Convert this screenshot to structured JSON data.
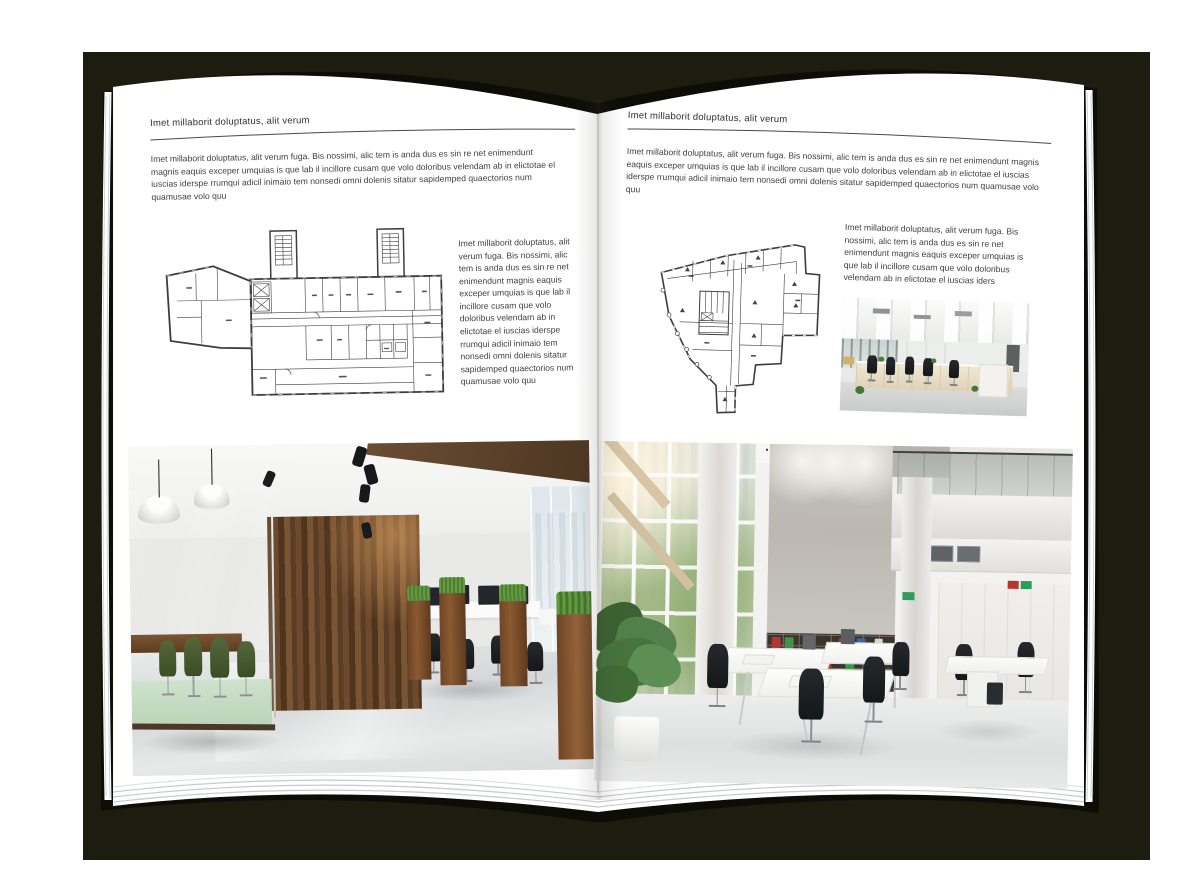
{
  "backdrop": {
    "color": "#1c1d0f"
  },
  "book": {
    "cover_color": "#0d0d07",
    "page_color": "#ffffff",
    "sheet_edge_color": "#c7cacc"
  },
  "left_page": {
    "header": "Imet millaborit doluptatus, alit verum",
    "intro": "Imet millaborit doluptatus, alit verum fuga. Bis nossimi, alic tem is anda dus es sin re net enimendunt magnis eaquis exceper umquias is que lab il incillore cusam que volo doloribus velendam ab in elictotae el iuscias iderspe rrumqui adicil inimaio tem nonsedi omni dolenis sitatur sapidemped quaectorios num quamusae volo quu",
    "side_text": "Imet millaborit doluptatus, alit verum fuga. Bis nossimi, alic tem is anda dus es sin re net enimendunt magnis eaquis exceper umquias is que lab il incillore cusam que volo doloribus velendam ab in elictotae el iuscias iderspe rrumqui adicil inimaio tem nonsedi omni dolenis sitatur sapidemped quaectorios num quamusae volo quu",
    "floorplan": "wide-office-building-floor-plan",
    "photo": "open-office-with-dark-glass-meeting-room-and-wood-wall"
  },
  "right_page": {
    "header": "Imet millaborit doluptatus, alit verum",
    "intro": "Imet millaborit doluptatus, alit verum fuga. Bis nossimi, alic tem is anda dus es sin re net enimendunt magnis eaquis exceper umquias is que lab il incillore cusam que volo doloribus velendam ab in elictotae el iuscias iderspe rrumqui adicil inimaio tem nonsedi omni dolenis sitatur sapidemped quaectorios num quamusae volo quu",
    "side_text": "Imet millaborit doluptatus, alit verum fuga. Bis nossimi, alic tem is anda dus es sin re net enimendunt magnis eaquis exceper umquias is que lab il incillore cusam que volo doloribus velendam ab in elictotae el iuscias iders",
    "floorplan": "irregular-corner-building-floor-plan",
    "photo_small": "white-open-office-desk-rows",
    "photo_large": "double-height-white-office-atrium",
    "binder_colors": [
      "#b23730",
      "#2e66a8",
      "#3f9246",
      "#d8d8d4"
    ]
  }
}
